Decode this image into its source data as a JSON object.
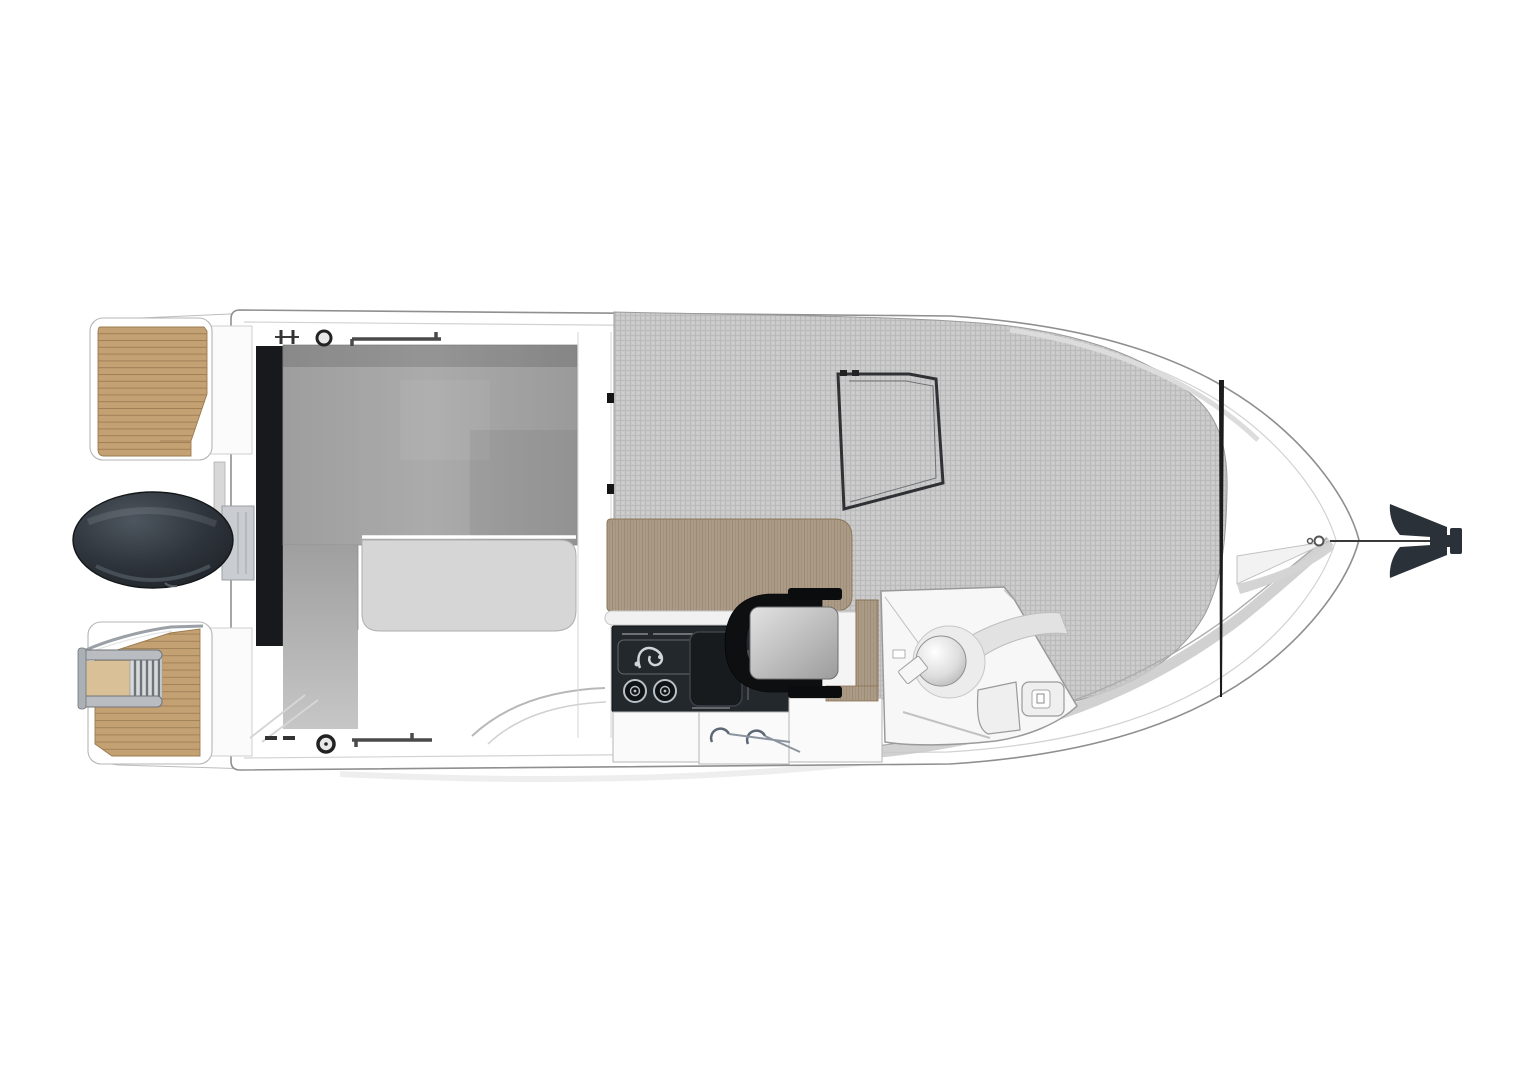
{
  "canvas": {
    "width": 1529,
    "height": 1080,
    "background": "#ffffff"
  },
  "colors": {
    "hull_fill": "#ffffff",
    "hull_stroke": "#8f8f8f",
    "inner_line": "#d2d2d2",
    "deck_band": "#c9c9c9",
    "teak": "#c4a173",
    "teak_line": "#94754c",
    "teak_light": "#d9c096",
    "metal": "#9aa0a6",
    "metal_dark": "#6f7478",
    "engine_sheen": "#4d565f",
    "engine_mid": "#2e343b",
    "engine_dark": "#1d2126",
    "transom_door_dark": "#17191c",
    "bench_gray": "#a4a4a4",
    "cushion_gray": "#d6d6d6",
    "texture_base": "#c9c9c9",
    "texture_line": "#b5b5b5",
    "wood_table": "#ab9a85",
    "wood_grain": "#95866f",
    "galley_unit_dark": "#23282c",
    "galley_steel": "#cfd6db",
    "cabinet_white": "#fafafa",
    "cabinet_stroke": "#b5b5b5",
    "handle_metal": "#5d6876",
    "seat_shell_black": "#0e0f11",
    "seat_cushion_light": "#dadada",
    "console_white": "#f7f7f7",
    "windshield_frame": "#2f3134",
    "bow_line_black": "#1c1c1c",
    "anchor_dark": "#2b3138",
    "hardware_dark": "#3c3c3c",
    "step_fill": "#efefef"
  },
  "parts": [
    "hull",
    "swim-platform-port",
    "swim-platform-starboard",
    "boarding-ladder",
    "outboard-engine",
    "transom-door",
    "cockpit-bench",
    "cockpit-seat-cushion",
    "galley-table",
    "galley-stove",
    "sink-faucet",
    "burners",
    "storage-cabinets",
    "companion-seat",
    "helm-console",
    "steering-wheel",
    "windshield-frame",
    "bow-sunpad",
    "anchor",
    "anchor-rode",
    "deck-cleat",
    "grab-rail",
    "deck-filler-cap"
  ]
}
